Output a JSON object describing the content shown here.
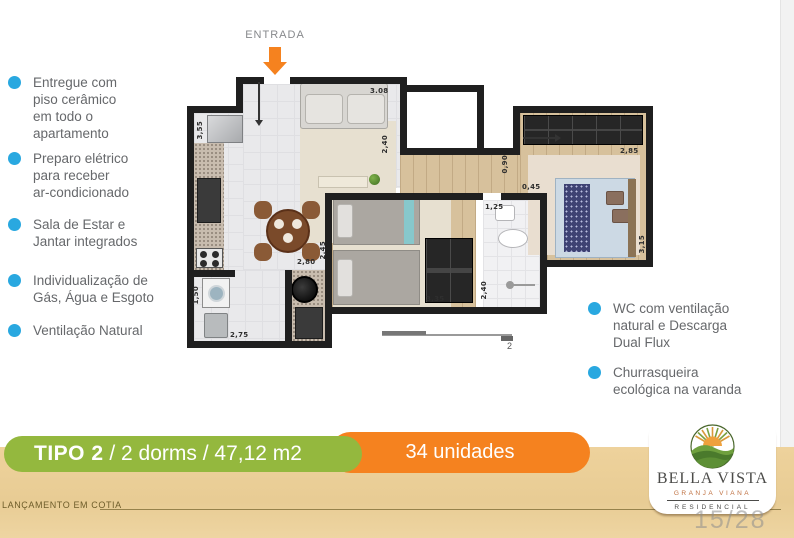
{
  "features_left": [
    "Entregue com\npiso cerâmico\nem todo o\napartamento",
    "Preparo elétrico\npara receber\nar-condicionado",
    "Sala de Estar e\nJantar integrados",
    "Individualização de\nGás, Água e Esgoto",
    "Ventilação Natural"
  ],
  "features_right": [
    "WC com ventilação\nnatural e Descarga\nDual Flux",
    "Churrasqueira\necológica na varanda"
  ],
  "entrance_label": "ENTRADA",
  "banner": {
    "tipo": "TIPO 2",
    "specs": " / 2 dorms / 47,12 m2",
    "units": "34 unidades"
  },
  "footer": {
    "caption": "LANÇAMENTO EM COTIA",
    "page": "15/28"
  },
  "logo": {
    "name": "BELLA VISTA",
    "location": "GRANJA VIANA",
    "category": "RESIDENCIAL"
  },
  "plan": {
    "dimensions": [
      "3,55",
      "3.08",
      "2,40",
      "0,90",
      "2,85",
      "0,45",
      "1,25",
      "2,45",
      "2,80",
      "3,35",
      "2,40",
      "2,75",
      "1,50",
      "3,15"
    ],
    "section_label": "2"
  },
  "colors": {
    "bullet": "#29A8E0",
    "green_banner": "#94B83E",
    "orange_banner": "#F5821F",
    "tan_strip": "#EDD29B"
  }
}
